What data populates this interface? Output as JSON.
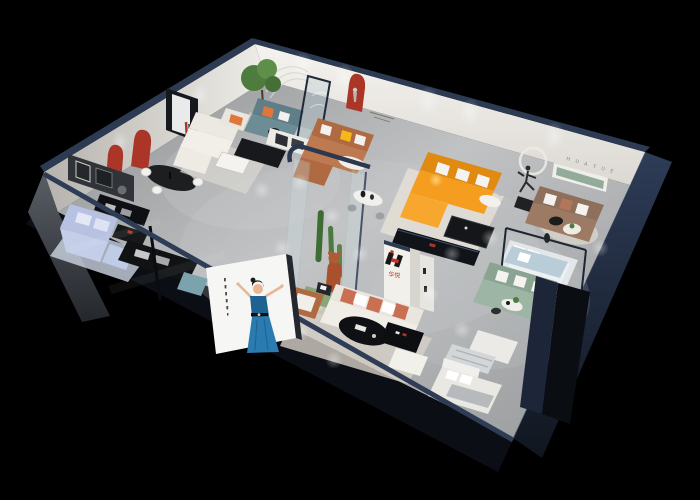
{
  "scene": {
    "description": "Isometric cutaway 3D render of a furniture showroom apartment on a black background",
    "background": "#000000"
  },
  "branding": {
    "logo_characters": "华悦",
    "wall_lettering": "H U A Y U E"
  },
  "colors": {
    "background": "#000000",
    "floor": "#a8aaac",
    "wall_white": "#f0eee9",
    "navy_edge": "#2c3a52",
    "navy_panel": "#1d2639",
    "facade_dark": "#0b0e14",
    "arch_red": "#ab3627",
    "logo_red": "#c13328",
    "sofa_periwinkle": "#b7c2e2",
    "sofa_cream": "#ece9e2",
    "sofa_teal": "#5f7e88",
    "sofa_caramel": "#b06a41",
    "sofa_orange": "#f59d1e",
    "sofa_brown": "#9c7a64",
    "sofa_sage": "#9db5a4",
    "sofa_lightblue": "#b9cdd9",
    "sofa_coral": "#c96f52",
    "pillow_orange": "#e0763a",
    "pillow_yellow": "#f5b719",
    "plant_green": "#4e7c3f",
    "atrium_green": "#8aa578",
    "bear_rust": "#a9502f",
    "shelf_green": "#93ab9b",
    "poster_bg": "#f6f6f4",
    "dress_blue": "#1d6290",
    "skin": "#e9b695",
    "table_black": "#0e1013"
  }
}
